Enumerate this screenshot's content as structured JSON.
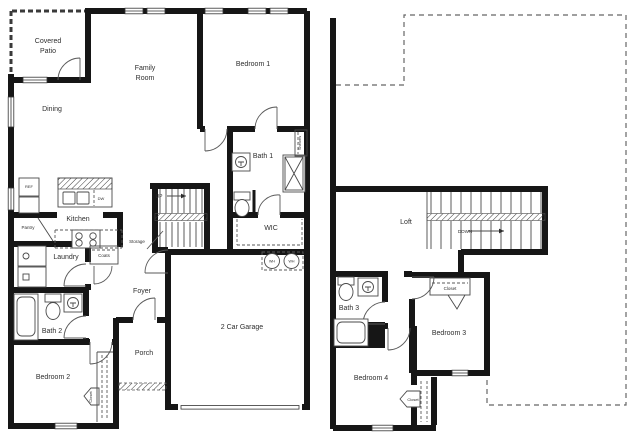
{
  "fp": {
    "f1": {
      "covered_patio1": "Covered",
      "covered_patio2": "Patio",
      "dining": "Dining",
      "family1": "Family",
      "family2": "Room",
      "bedroom1": "Bedroom 1",
      "bath1": "Bath 1",
      "wic": "WIC",
      "shelves": "Shelves",
      "kitchen": "Kitchen",
      "pantry": "Pantry",
      "ref": "REF",
      "dw": "DW",
      "laundry": "Laundry",
      "coats": "Coats",
      "storage": "Storage",
      "up": "UP",
      "foyer": "Foyer",
      "porch": "Porch",
      "bath2": "Bath 2",
      "bedroom2": "Bedroom 2",
      "closet_bedroom2": "Closet",
      "garage": "2 Car Garage",
      "wh1": "WH",
      "wh2": "WH"
    },
    "f2": {
      "loft": "Loft",
      "down": "DOWN",
      "bath3": "Bath 3",
      "bedroom3": "Bedroom 3",
      "bedroom4": "Bedroom 4",
      "closet_bedroom3": "Closet",
      "closet_bedroom4": "Closet"
    },
    "colors": {
      "walls": "#161616",
      "text": "#2e2e2e",
      "background": "#ffffff",
      "dashed_lines": "#666666"
    }
  }
}
